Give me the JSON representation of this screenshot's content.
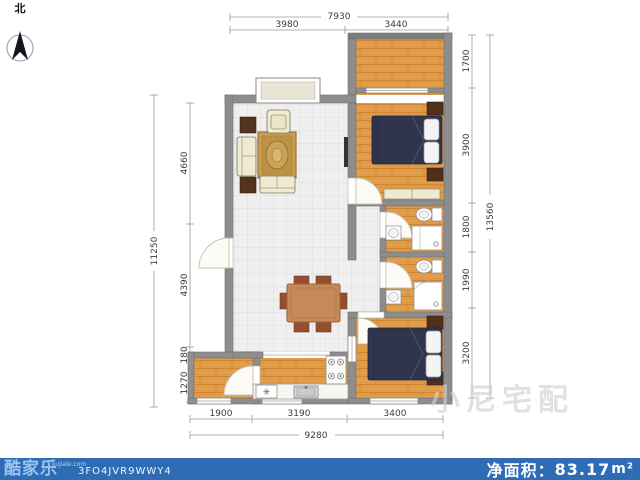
{
  "compass": {
    "label": "北"
  },
  "dimensions": {
    "top": {
      "total": "7930",
      "segments": [
        "3980",
        "3440"
      ]
    },
    "bottom": {
      "total": "9280",
      "segments": [
        "1900",
        "3190",
        "3400"
      ]
    },
    "left": {
      "total": "11250",
      "segments": [
        "4660",
        "4390",
        "180",
        "1270"
      ]
    },
    "right": {
      "total": "13560",
      "segments": [
        "1700",
        "3900",
        "1800",
        "1990",
        "3200"
      ]
    }
  },
  "footer": {
    "brand": "酷家乐",
    "brand_site": "kujiale.com",
    "plan_code": "3FO4JVR9WWY4",
    "area_label": "净面积：",
    "area_value": "83.17",
    "area_unit": "m²"
  },
  "watermark": {
    "text": "小尼宅配"
  },
  "kitchen": {
    "fridge_symbol": "✳"
  },
  "colors": {
    "footer_bar": "#2e6db6",
    "wall": "#8d8d8d",
    "wood_floor": "#e19b46",
    "tile_floor": "#efeff0",
    "bed": "#30344d",
    "sofa": "#f0ead0",
    "rug": "#c79e52"
  }
}
